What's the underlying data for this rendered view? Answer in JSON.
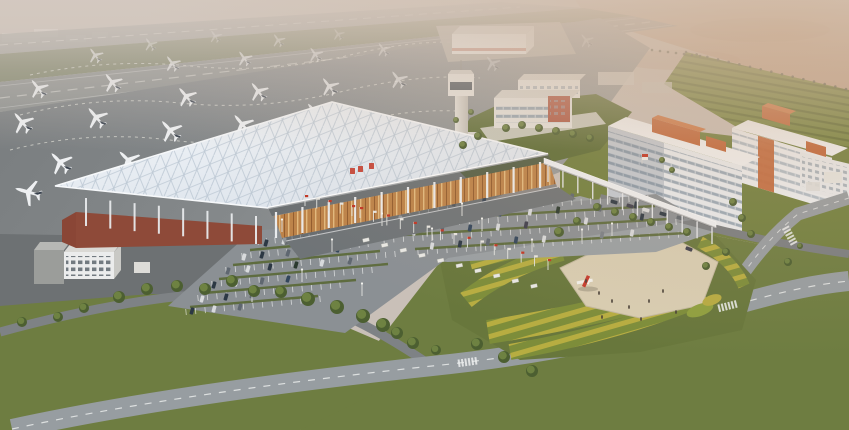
{
  "meta": {
    "description": "Aerial architectural rendering of an airport complex: runways and apron with parked white aircraft, a terminal with a white lattice space-frame roof over a red-brown base and amber glass facade, a control tower, white office and hotel blocks with orange rooftop accents, surface parking lots with cars and flag poles, a landscaped plaza with a red airplane monument, striped flower gardens, tree-lined lawns and curved boulevards under hazy warm light.",
    "visible_text": "none (illegible red signage glyphs on terminal roof only)"
  },
  "palette": {
    "sky": "#c9c0b8",
    "desert": "#bfa28c",
    "runway": "#8d908e",
    "grassStrip": "#7c8267",
    "tarmacDark": "#6d7173",
    "redBase": "#8e4a39",
    "orange": "#c2673a",
    "campusRed": "#b05742",
    "towerDark": "#49525a",
    "lawn": "#6e7d41",
    "lawn2": "#71803f",
    "lawnDark": "#5f6f39",
    "road": "#979da1",
    "landside": "#9aa0a3",
    "parking": "#8b9094",
    "plaza": "#d8cdb2",
    "monumentRed": "#c53b2e",
    "flagRed": "#c23524",
    "flagWhite": "#e9e7e2",
    "hedge": "#5a6936"
  },
  "scene": {
    "airfield": {
      "label": "runways, taxiways and apron",
      "aircraft_count": 25
    },
    "terminal": {
      "label": "terminal with white lattice roof, red-brown base, amber glass facade, curbside canopy"
    },
    "control_tower": {
      "label": "air traffic control tower"
    },
    "cargo_building": {
      "label": "distant airside cargo building"
    },
    "campus": {
      "label": "mid-rise airport support buildings with red accent block"
    },
    "hotels": {
      "label": "white hotel/office slabs with orange rooftop boxes",
      "count": 3
    },
    "parking": {
      "label": "surface parking lots with cars, hedges, flags and light posts"
    },
    "plaza": {
      "label": "beige plaza with red airplane monument and tiny figures"
    },
    "gardens": {
      "label": "curved striped flower beds around plaza"
    },
    "roads": {
      "label": "curved boulevards with dashed markings and crosswalks"
    }
  },
  "layers": {
    "aircraft": [
      [
        150,
        44,
        1.0,
        -35,
        0.55
      ],
      [
        215,
        36,
        0.95,
        -35,
        0.45
      ],
      [
        278,
        40,
        1.0,
        -35,
        0.55
      ],
      [
        338,
        34,
        0.9,
        -35,
        0.4
      ],
      [
        95,
        55,
        1.15,
        -36,
        0.75
      ],
      [
        172,
        63,
        1.2,
        -36,
        0.8
      ],
      [
        244,
        58,
        1.15,
        -36,
        0.75
      ],
      [
        315,
        54,
        1.1,
        -36,
        0.65
      ],
      [
        383,
        49,
        1.05,
        -36,
        0.55
      ],
      [
        38,
        88,
        1.45,
        -38,
        0.95
      ],
      [
        112,
        82,
        1.45,
        -38,
        0.95
      ],
      [
        186,
        96,
        1.5,
        -40,
        1
      ],
      [
        258,
        91,
        1.45,
        -38,
        0.95
      ],
      [
        329,
        86,
        1.4,
        -38,
        0.85
      ],
      [
        398,
        79,
        1.35,
        -37,
        0.7
      ],
      [
        22,
        122,
        1.65,
        -40,
        1
      ],
      [
        96,
        117,
        1.65,
        -40,
        1
      ],
      [
        170,
        130,
        1.7,
        -42,
        1
      ],
      [
        242,
        124,
        1.65,
        -40,
        1
      ],
      [
        315,
        112,
        1.55,
        -40,
        0.9
      ],
      [
        60,
        162,
        1.75,
        -44,
        1
      ],
      [
        128,
        160,
        1.7,
        -45,
        1
      ],
      [
        28,
        192,
        1.9,
        -74,
        1
      ],
      [
        492,
        63,
        1.15,
        -38,
        0.4
      ],
      [
        586,
        40,
        1.05,
        -38,
        0.35
      ]
    ],
    "trees": [
      [
        22,
        322,
        5
      ],
      [
        58,
        317,
        5
      ],
      [
        84,
        308,
        5
      ],
      [
        119,
        297,
        6
      ],
      [
        147,
        289,
        6
      ],
      [
        177,
        286,
        6
      ],
      [
        205,
        289,
        6
      ],
      [
        232,
        281,
        6
      ],
      [
        254,
        291,
        6
      ],
      [
        281,
        292,
        6
      ],
      [
        308,
        299,
        7
      ],
      [
        337,
        307,
        7
      ],
      [
        363,
        316,
        7
      ],
      [
        383,
        325,
        7
      ],
      [
        397,
        333,
        6
      ],
      [
        413,
        343,
        6
      ],
      [
        436,
        350,
        5
      ],
      [
        477,
        344,
        6
      ],
      [
        504,
        357,
        6
      ],
      [
        532,
        371,
        6
      ],
      [
        733,
        202,
        4
      ],
      [
        742,
        218,
        4
      ],
      [
        751,
        234,
        4
      ],
      [
        726,
        252,
        4
      ],
      [
        706,
        266,
        4
      ],
      [
        788,
        262,
        4
      ],
      [
        800,
        246,
        3
      ],
      [
        597,
        207,
        4
      ],
      [
        615,
        212,
        4
      ],
      [
        633,
        217,
        4
      ],
      [
        651,
        222,
        4
      ],
      [
        669,
        227,
        4
      ],
      [
        687,
        232,
        4
      ],
      [
        577,
        221,
        4
      ],
      [
        559,
        232,
        5
      ],
      [
        506,
        128,
        4
      ],
      [
        522,
        125,
        4
      ],
      [
        539,
        128,
        4
      ],
      [
        556,
        131,
        4
      ],
      [
        573,
        134,
        4
      ],
      [
        590,
        138,
        4
      ],
      [
        478,
        136,
        4
      ],
      [
        463,
        145,
        4
      ],
      [
        471,
        112,
        3
      ],
      [
        456,
        120,
        3
      ],
      [
        662,
        160,
        3
      ],
      [
        672,
        170,
        3
      ]
    ],
    "cars": {
      "size": [
        7,
        3.6
      ],
      "colors": [
        "#2c3844",
        "#d8dadc",
        "#5f6770",
        "#33465c",
        "#2b3a2f",
        "#7a8087",
        "#3f3f4d",
        "#c8cacc"
      ],
      "items": [
        [
          418,
          206,
          -80,
          0
        ],
        [
          436,
          204,
          -80,
          1
        ],
        [
          454,
          203,
          -80,
          2
        ],
        [
          484,
          201,
          -80,
          3
        ],
        [
          514,
          199,
          -80,
          1
        ],
        [
          546,
          198,
          -80,
          4
        ],
        [
          572,
          197,
          -80,
          2
        ],
        [
          400,
          219,
          -80,
          1
        ],
        [
          422,
          218,
          -80,
          0
        ],
        [
          452,
          216,
          -80,
          2
        ],
        [
          472,
          215,
          -80,
          1
        ],
        [
          500,
          213,
          -80,
          3
        ],
        [
          530,
          212,
          -80,
          1
        ],
        [
          558,
          210,
          -80,
          4
        ],
        [
          600,
          208,
          -80,
          2
        ],
        [
          636,
          205,
          -80,
          0
        ],
        [
          394,
          233,
          -80,
          0
        ],
        [
          414,
          232,
          -80,
          1
        ],
        [
          442,
          230,
          -80,
          2
        ],
        [
          470,
          228,
          -80,
          3
        ],
        [
          498,
          227,
          -80,
          1
        ],
        [
          526,
          225,
          -80,
          6
        ],
        [
          586,
          221,
          -80,
          1
        ],
        [
          642,
          217,
          -80,
          0
        ],
        [
          432,
          246,
          -80,
          1
        ],
        [
          460,
          244,
          -80,
          0
        ],
        [
          488,
          242,
          -80,
          2
        ],
        [
          516,
          240,
          -80,
          3
        ],
        [
          544,
          239,
          -80,
          1
        ],
        [
          602,
          235,
          -80,
          5
        ],
        [
          632,
          233,
          -80,
          1
        ],
        [
          266,
          243,
          -74,
          0
        ],
        [
          284,
          241,
          -74,
          1
        ],
        [
          304,
          240,
          -74,
          2
        ],
        [
          324,
          238,
          -74,
          3
        ],
        [
          244,
          257,
          -74,
          1
        ],
        [
          262,
          255,
          -74,
          0
        ],
        [
          288,
          253,
          -74,
          2
        ],
        [
          312,
          251,
          -74,
          1
        ],
        [
          338,
          249,
          -74,
          3
        ],
        [
          228,
          271,
          -74,
          2
        ],
        [
          248,
          269,
          -74,
          1
        ],
        [
          270,
          267,
          -74,
          0
        ],
        [
          296,
          265,
          -74,
          4
        ],
        [
          322,
          263,
          -74,
          1
        ],
        [
          350,
          261,
          -74,
          2
        ],
        [
          214,
          285,
          -74,
          0
        ],
        [
          236,
          283,
          -74,
          1
        ],
        [
          262,
          281,
          -74,
          2
        ],
        [
          288,
          279,
          -74,
          3
        ],
        [
          202,
          299,
          -74,
          1
        ],
        [
          226,
          297,
          -74,
          0
        ],
        [
          252,
          295,
          -74,
          2
        ],
        [
          192,
          311,
          -74,
          0
        ],
        [
          214,
          309,
          -74,
          1
        ],
        [
          240,
          307,
          -74,
          2
        ],
        [
          614,
          202,
          16,
          0
        ],
        [
          630,
          206,
          16,
          6
        ],
        [
          646,
          210,
          16,
          1
        ],
        [
          663,
          214,
          16,
          0
        ],
        [
          680,
          218,
          16,
          2
        ],
        [
          689,
          249,
          20,
          6
        ]
      ]
    },
    "stall_rows": [
      [
        400,
        212,
        648,
        198,
        26
      ],
      [
        392,
        226,
        662,
        210,
        28
      ],
      [
        384,
        240,
        676,
        222,
        30
      ],
      [
        418,
        252,
        688,
        234,
        28
      ],
      [
        258,
        242,
        352,
        233,
        11
      ],
      [
        242,
        256,
        368,
        244,
        14
      ],
      [
        226,
        270,
        395,
        254,
        18
      ],
      [
        212,
        284,
        372,
        270,
        17
      ],
      [
        198,
        298,
        340,
        285,
        15
      ],
      [
        186,
        312,
        320,
        299,
        14
      ]
    ],
    "hedges": [
      [
        397,
        221,
        655,
        206
      ],
      [
        387,
        236,
        668,
        219
      ],
      [
        415,
        249,
        686,
        233
      ],
      [
        250,
        250,
        358,
        240
      ],
      [
        233,
        265,
        380,
        251
      ],
      [
        219,
        279,
        388,
        264
      ],
      [
        204,
        293,
        356,
        280
      ],
      [
        190,
        307,
        318,
        296
      ]
    ],
    "flag_rows": [
      {
        "x1": 360,
        "y1": 218,
        "x2": 548,
        "y2": 270,
        "n": 15
      },
      {
        "x1": 305,
        "y1": 206,
        "x2": 352,
        "y2": 216,
        "n": 5
      }
    ],
    "planters": {
      "x1": 366,
      "y1": 240,
      "x2": 534,
      "y2": 286,
      "n": 10
    },
    "light_posts": [
      [
        282,
        232
      ],
      [
        332,
        252
      ],
      [
        382,
        226
      ],
      [
        432,
        241
      ],
      [
        482,
        231
      ],
      [
        532,
        252
      ],
      [
        582,
        242
      ],
      [
        302,
        282
      ],
      [
        362,
        296
      ],
      [
        252,
        302
      ],
      [
        612,
        236
      ],
      [
        462,
        216
      ]
    ],
    "people": [
      [
        586,
        281
      ],
      [
        599,
        293
      ],
      [
        612,
        301
      ],
      [
        629,
        307
      ],
      [
        649,
        301
      ],
      [
        663,
        291
      ],
      [
        641,
        319
      ],
      [
        602,
        317
      ],
      [
        676,
        312
      ]
    ],
    "canopy_columns": {
      "x1": 548,
      "y1": 165,
      "x2": 712,
      "y2": 227,
      "n": 12,
      "len": 17
    },
    "facade_columns": {
      "x1": 276,
      "y1": 212,
      "x2": 540,
      "y2": 162,
      "n": 11,
      "len": 26
    },
    "left_columns": {
      "x1": 86,
      "y1": 198,
      "x2": 256,
      "y2": 216,
      "n": 8,
      "len": 28
    },
    "fence_rows": [
      {
        "x1": 548,
        "y1": 37,
        "x2": 700,
        "y2": 56,
        "n": 20
      },
      {
        "x1": 686,
        "y1": 52,
        "x2": 846,
        "y2": 89,
        "n": 16
      }
    ],
    "crosswalks": [
      [
        468,
        362,
        -8
      ],
      [
        728,
        306,
        -14
      ],
      [
        790,
        236,
        62
      ]
    ]
  }
}
